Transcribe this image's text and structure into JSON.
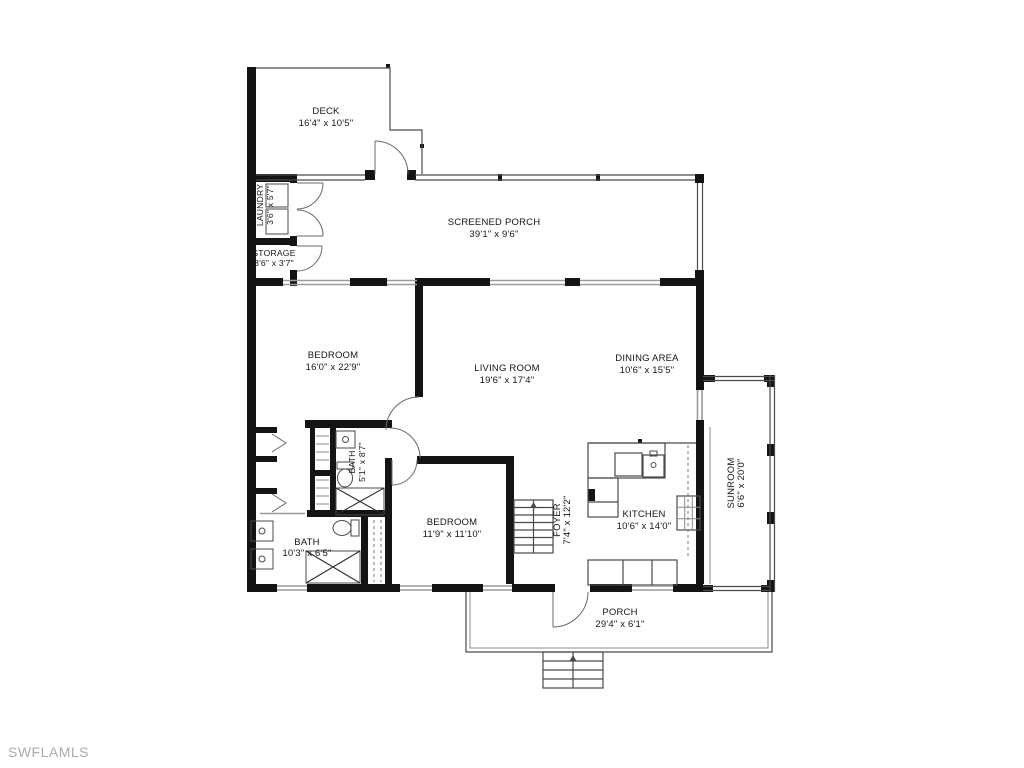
{
  "watermark": "SWFLAMLS",
  "colors": {
    "wall": "#141414",
    "thin_line": "#4a4a4a",
    "window_line": "#9c9c9c",
    "label_text": "#161616",
    "watermark_text": "#ababab",
    "background": "#ffffff"
  },
  "rooms": {
    "deck": {
      "name": "DECK",
      "dims": "16'4\" x 10'5\""
    },
    "screened_porch": {
      "name": "SCREENED PORCH",
      "dims": "39'1\" x 9'6\""
    },
    "laundry": {
      "name": "LAUNDRY",
      "dims": "3'6\" x 5'7\""
    },
    "storage": {
      "name": "STORAGE",
      "dims": "3'6\" x 3'7\""
    },
    "bedroom1": {
      "name": "BEDROOM",
      "dims": "16'0\" x 22'9\""
    },
    "living_room": {
      "name": "LIVING ROOM",
      "dims": "19'6\" x 17'4\""
    },
    "dining_area": {
      "name": "DINING AREA",
      "dims": "10'6\" x 15'5\""
    },
    "bath1": {
      "name": "BATH",
      "dims": "5'1\" x 8'7\""
    },
    "bath2": {
      "name": "BATH",
      "dims": "10'3\" x 6'5\""
    },
    "bedroom2": {
      "name": "BEDROOM",
      "dims": "11'9\" x 11'10\""
    },
    "foyer": {
      "name": "FOYER",
      "dims": "7'4\" x 12'2\""
    },
    "kitchen": {
      "name": "KITCHEN",
      "dims": "10'6\" x 14'0\""
    },
    "sunroom": {
      "name": "SUNROOM",
      "dims": "6'6\" x 20'0\""
    },
    "porch": {
      "name": "PORCH",
      "dims": "29'4\" x 6'1\""
    }
  }
}
